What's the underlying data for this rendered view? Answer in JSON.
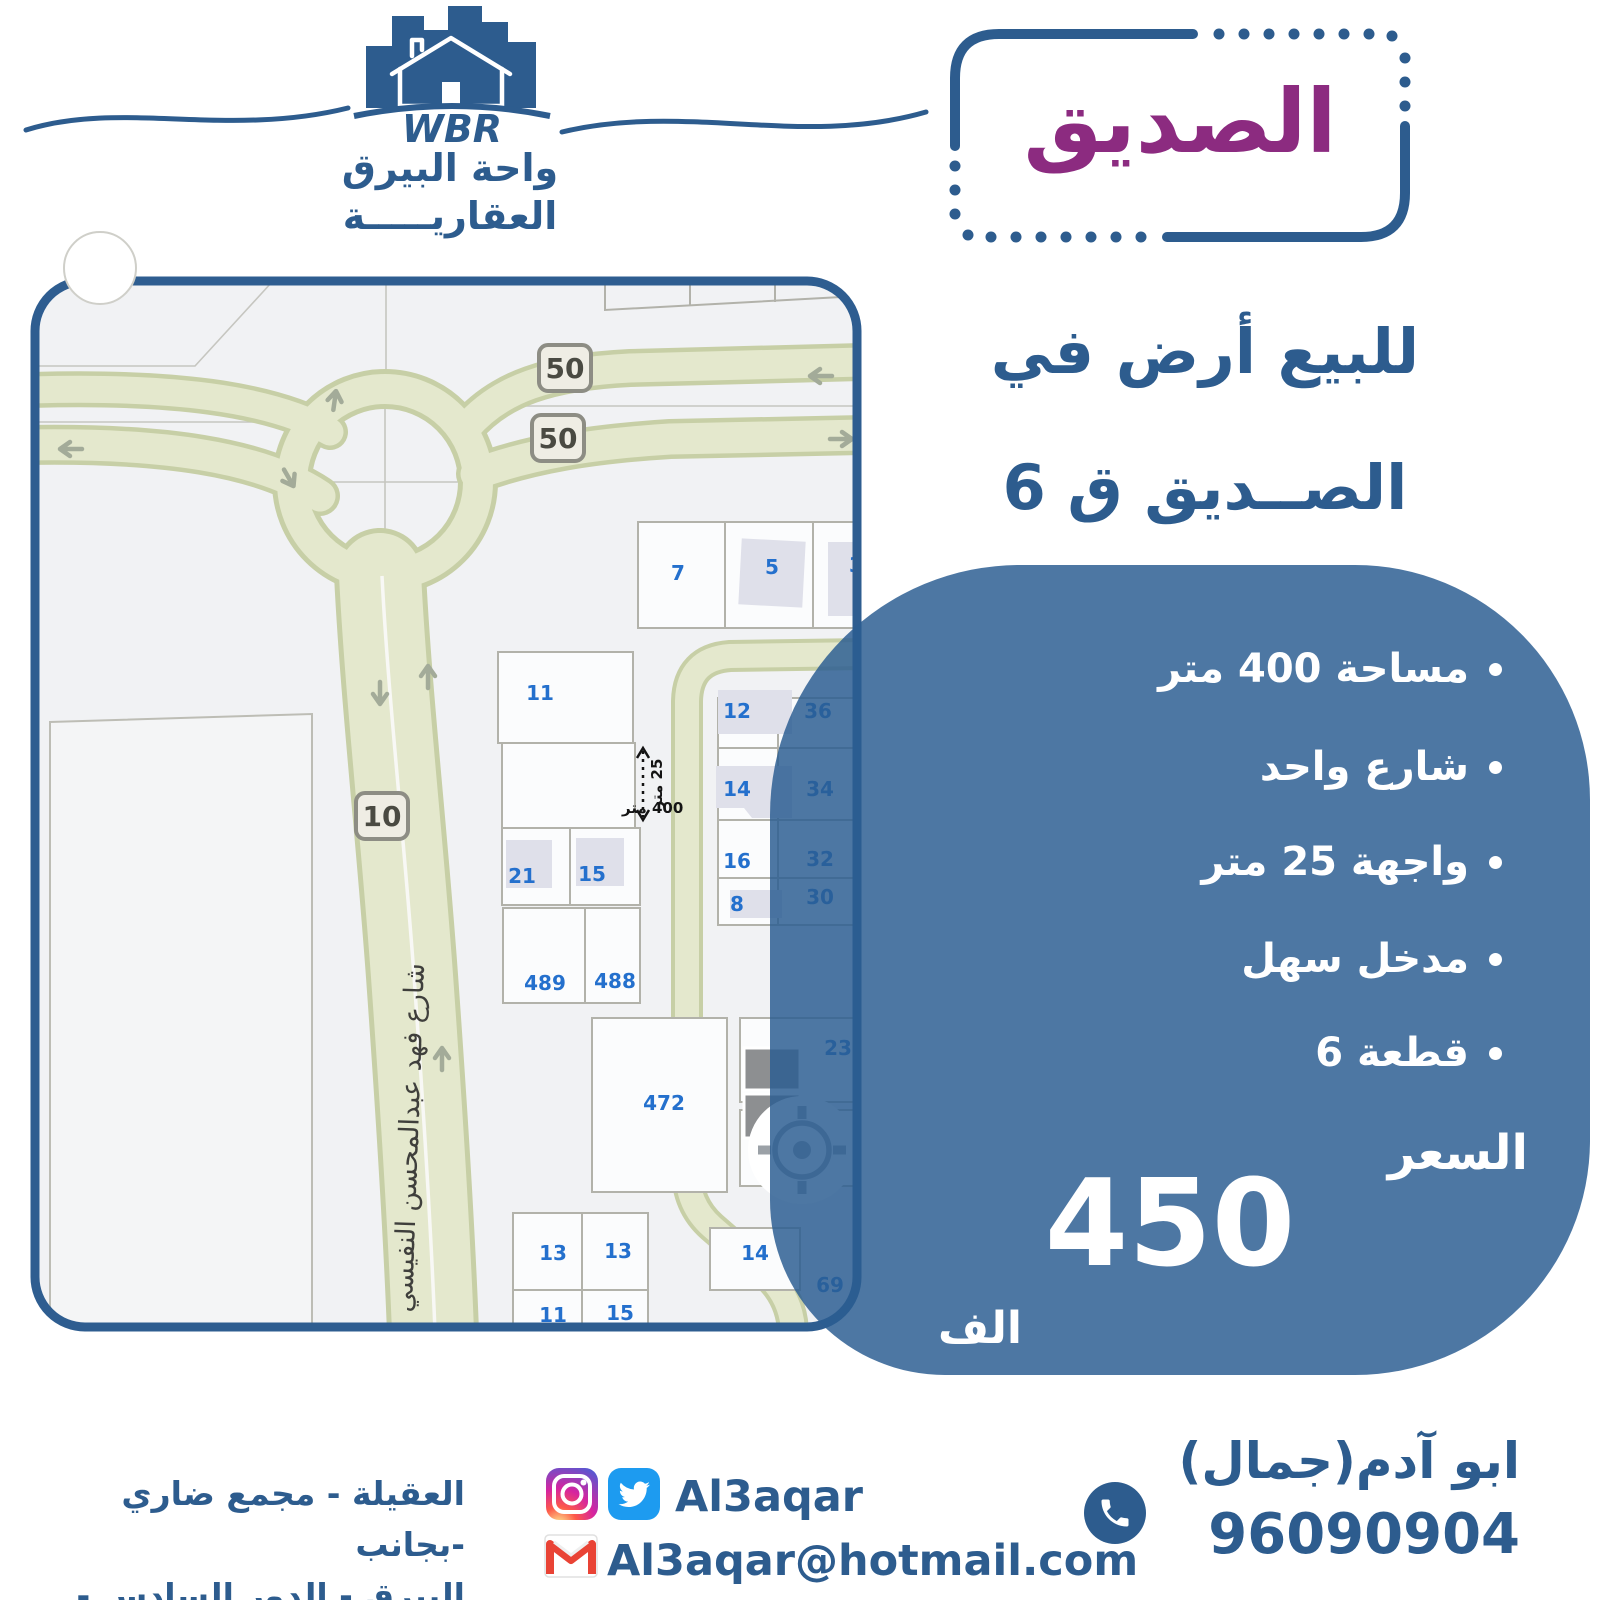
{
  "brand": {
    "wbr": "WBR",
    "name_line1": "واحة البيرق",
    "name_line2": "العقاريـــــة"
  },
  "title_badge": {
    "text": "الصديق"
  },
  "headline": {
    "line1": "للبيع أرض في",
    "line2": "الصــديق ق 6"
  },
  "card": {
    "features": [
      "مساحة 400 متر",
      "شارع واحد",
      "واجهة 25 متر",
      "مدخل سهل",
      "قطعة 6"
    ],
    "price_label": "السعر",
    "price_value": "450",
    "price_unit": "الف"
  },
  "map": {
    "street_name": "شارع فهد عبدالمحسن النفيسي",
    "road_badges": [
      "50",
      "50",
      "10"
    ],
    "measure": {
      "area_label": "400 متر",
      "front_label": "25 متر"
    },
    "plots": [
      "7",
      "5",
      "3",
      "11",
      "12",
      "36",
      "14",
      "34",
      "16",
      "32",
      "8",
      "30",
      "21",
      "15",
      "489",
      "488",
      "472",
      "23",
      "5",
      "13",
      "13",
      "11",
      "15",
      "14",
      "69"
    ]
  },
  "footer": {
    "address_line1": "العقيلة - مجمع ضاري -بجانب",
    "address_line2": "البيرق - الدور السادس - مكتب 6",
    "social_handle": "Al3aqar",
    "email": "Al3aqar@hotmail.com",
    "agent_name": "ابو آدم(جمال)",
    "phone": "96090904"
  },
  "colors": {
    "primary_blue": "#2d5c8e",
    "card_blue": "#4d77a3",
    "purple": "#8c2b80",
    "road_olive": "#e4e8cd",
    "plot_label_blue": "#2470cd"
  }
}
